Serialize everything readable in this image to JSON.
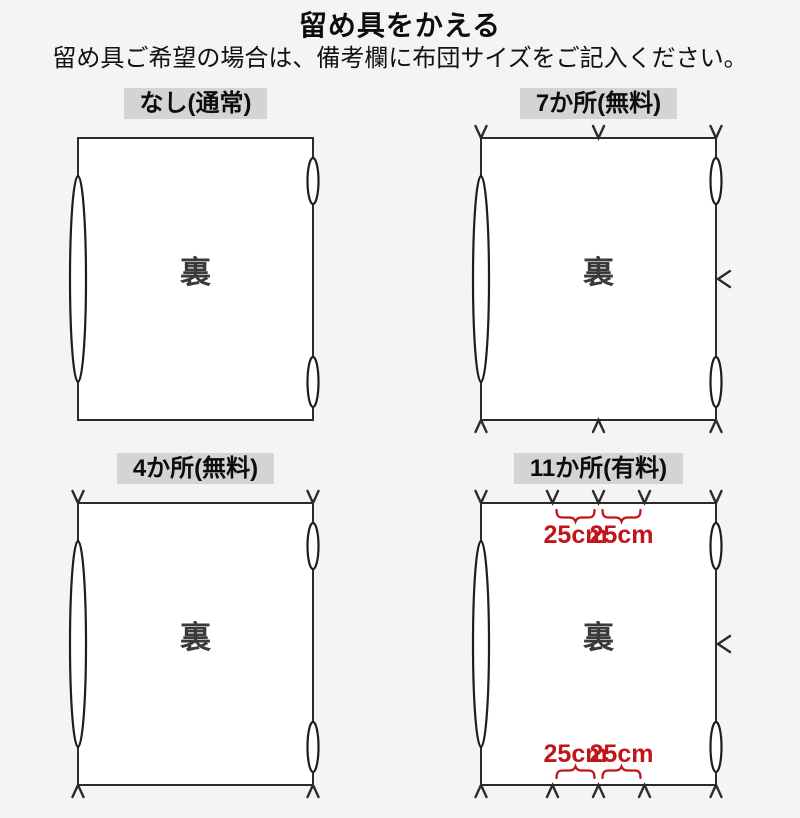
{
  "page": {
    "title": "留め具をかえる",
    "subtitle": "留め具ご希望の場合は、備考欄に布団サイズをご記入ください。"
  },
  "colors": {
    "background": "#f4f4f4",
    "line": "#2b2b2b",
    "label_background": "#d4d4d4",
    "accent_red": "#c1151c",
    "back_text_gray": "#3a3a3a"
  },
  "panels": [
    {
      "label": "なし(通常)",
      "back_label": "裏",
      "marks": {
        "top": 0,
        "bottom": 0,
        "right": 0
      }
    },
    {
      "label": "7か所(無料)",
      "back_label": "裏",
      "marks": {
        "top": 3,
        "bottom": 3,
        "right": 1
      }
    },
    {
      "label": "4か所(無料)",
      "back_label": "裏",
      "marks": {
        "top": 2,
        "bottom": 2,
        "right": 0
      }
    },
    {
      "label": "11か所(有料)",
      "back_label": "裏",
      "marks": {
        "top": 5,
        "bottom": 5,
        "right": 1
      },
      "dimensions": {
        "top": [
          "25cm",
          "25cm"
        ],
        "bottom": [
          "25cm",
          "25cm"
        ]
      }
    }
  ]
}
